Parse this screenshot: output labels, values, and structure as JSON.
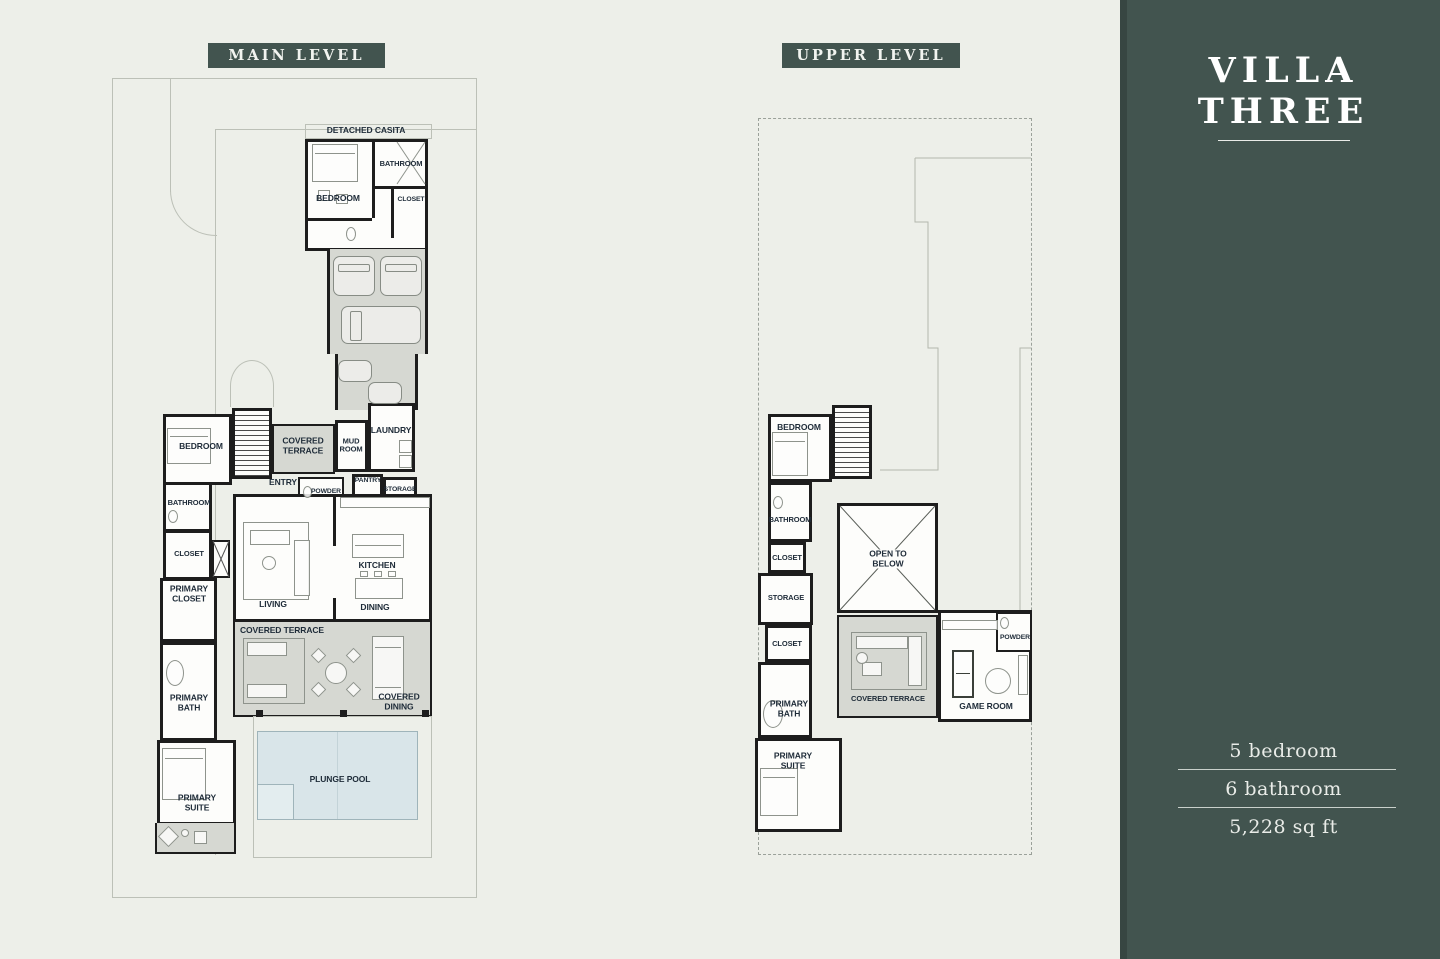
{
  "colors": {
    "bg": "#edefe9",
    "panel": "#42544f",
    "wall": "#1d1d1d",
    "terrace": "#d6d8d2",
    "pool": "#d9e5e9",
    "poolBorder": "#9fb4ba",
    "label": "#1e2b38",
    "site": "#bcc0b7",
    "badgeText": "#f2f4f0",
    "panelText": "#e9ece8"
  },
  "headers": {
    "main": "MAIN LEVEL",
    "upper": "UPPER LEVEL"
  },
  "panel": {
    "title": "VILLA THREE",
    "stats": {
      "bedrooms": "5 bedroom",
      "bathrooms": "6 bathroom",
      "area": "5,228 sq ft"
    }
  },
  "main_level": {
    "labels": {
      "detached_casita": "DETACHED CASITA",
      "casita_bedroom": "BEDROOM",
      "casita_bathroom": "BATHROOM",
      "casita_closet": "CLOSET",
      "covered_terrace_entry": "COVERED TERRACE",
      "mud_room": "MUD ROOM",
      "laundry": "LAUNDRY",
      "entry": "ENTRY",
      "powder": "POWDER",
      "pantry": "PANTRY",
      "storage": "STORAGE",
      "bedroom": "BEDROOM",
      "bathroom": "BATHROOM",
      "closet": "CLOSET",
      "primary_closet": "PRIMARY CLOSET",
      "living": "LIVING",
      "kitchen": "KITCHEN",
      "dining": "DINING",
      "covered_terrace": "COVERED TERRACE",
      "covered_dining": "COVERED DINING",
      "primary_bath": "PRIMARY BATH",
      "primary_suite": "PRIMARY SUITE",
      "plunge_pool": "PLUNGE POOL"
    }
  },
  "upper_level": {
    "labels": {
      "bedroom": "BEDROOM",
      "bathroom": "BATHROOM",
      "closet_a": "CLOSET",
      "storage": "STORAGE",
      "open_to_below": "OPEN TO BELOW",
      "closet_b": "CLOSET",
      "primary_bath": "PRIMARY BATH",
      "primary_suite": "PRIMARY SUITE",
      "covered_terrace": "COVERED TERRACE",
      "game_room": "GAME ROOM",
      "powder": "POWDER"
    }
  }
}
